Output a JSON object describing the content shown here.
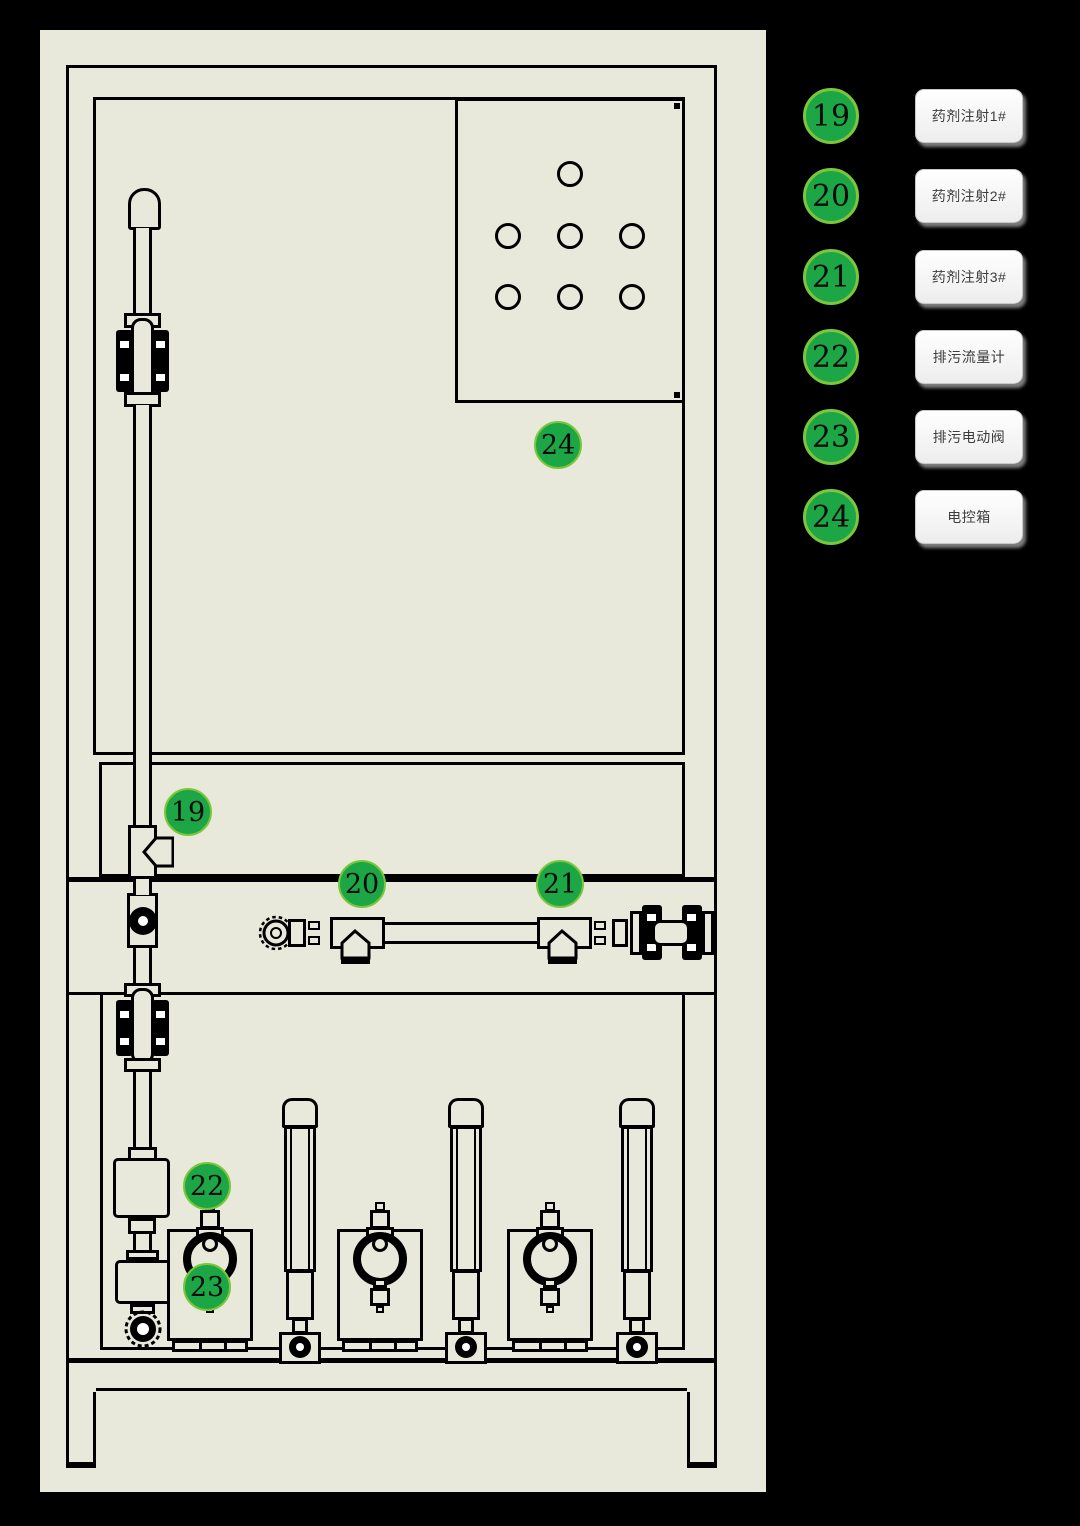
{
  "legend": {
    "items": [
      {
        "number": "19",
        "label": "药剂注射1#"
      },
      {
        "number": "20",
        "label": "药剂注射2#"
      },
      {
        "number": "21",
        "label": "药剂注射3#"
      },
      {
        "number": "22",
        "label": "排污流量计"
      },
      {
        "number": "23",
        "label": "排污电动阀"
      },
      {
        "number": "24",
        "label": "电控箱"
      }
    ]
  },
  "drawing": {
    "markers": [
      {
        "number": "19",
        "x": 148,
        "y": 782
      },
      {
        "number": "20",
        "x": 322,
        "y": 854
      },
      {
        "number": "21",
        "x": 520,
        "y": 854
      },
      {
        "number": "22",
        "x": 167,
        "y": 1156
      },
      {
        "number": "23",
        "x": 167,
        "y": 1257
      },
      {
        "number": "24",
        "x": 518,
        "y": 415
      }
    ]
  },
  "colors": {
    "background": "#000000",
    "panel": "#E8E8DB",
    "line": "#000000",
    "marker_fill": "#1CA645",
    "marker_rim": "#7DC63A",
    "button_text": "#3C3C3C"
  }
}
